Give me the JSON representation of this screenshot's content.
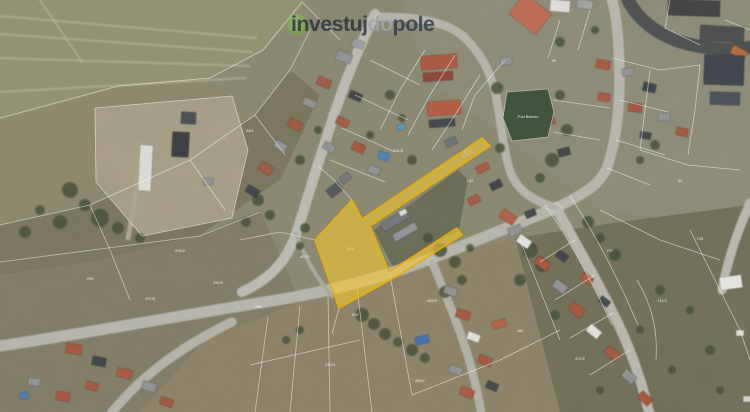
{
  "logo": {
    "part1": "investuj",
    "part2": "do",
    "part3": "pole",
    "part1_color": "rgba(37,47,60,0.80)",
    "part2_color": "rgba(157,165,172,0.85)",
    "part3_color": "rgba(42,55,70,0.80)",
    "mark_color": "rgba(110,170,60,0.55)"
  },
  "highlight": {
    "path": "M352,200 L362,219 L482,138 L490,146 L370,226 L389,272 L457,228 L462,235 L397,276 L339,308 L315,240 Z",
    "fill": "#f8c92f",
    "fill_opacity": 0.58,
    "stroke": "#e7b007"
  },
  "pond": {
    "path": "M507,92 L548,89 L554,112 L548,137 L512,141 L503,118 Z",
    "fill": "#3b5038",
    "label": "Pod Březím",
    "label_x": 528,
    "label_y": 118
  },
  "map": {
    "regions": [
      {
        "pts": "0,0 750,0 750,412 0,412",
        "fill": "#88866e",
        "op": 1
      },
      {
        "pts": "400,0 750,0 750,230 600,210 430,80",
        "fill": "#8e8c7a",
        "op": 0.65
      },
      {
        "pts": "0,0 308,0 262,52 208,80 118,88 0,120",
        "fill": "#91906f",
        "op": 1
      },
      {
        "pts": "0,120 118,88 208,80 250,120 170,170 60,205 0,225",
        "fill": "#8b8568",
        "op": 1
      },
      {
        "pts": "0,225 90,205 190,160 255,115 290,70 320,95 280,180 200,235 90,262 0,275",
        "fill": "#767157",
        "op": 0.9
      },
      {
        "pts": "95,108 232,96 248,150 232,218 142,236 96,182",
        "fill": "#a79d85",
        "op": 1
      },
      {
        "pts": "0,275 90,262 200,235 260,210 300,302 205,340 140,412 0,412",
        "fill": "#7d7861",
        "op": 0.9
      },
      {
        "pts": "140,412 205,340 300,302 430,262 515,238 560,412",
        "fill": "#8b8065",
        "op": 1
      },
      {
        "pts": "515,238 560,412 750,412 750,205 620,222",
        "fill": "#6e6b53",
        "op": 1
      },
      {
        "pts": "374,230 458,170 468,180 459,230 393,267",
        "fill": "#5a5e47",
        "op": 0.75
      }
    ],
    "tracks": [
      "M0,16 L256,38",
      "M0,34 L252,52",
      "M0,58 L250,66",
      "M0,92 L246,78",
      "M40,0 L82,62"
    ],
    "roads": [
      {
        "d": "M628,0 C638,20 658,36 688,44 C714,50 736,51 750,47",
        "w": 13,
        "c": "#4b4e4f",
        "e": 0
      },
      {
        "d": "M375,14 C360,45 341,90 326,140 C315,172 306,204 296,234 C287,260 272,278 242,292",
        "w": 9,
        "c": "#bab9b0",
        "e": 1
      },
      {
        "d": "M0,346 C100,331 200,312 265,302 C330,292 380,278 425,261 C455,249 522,222 556,208",
        "w": 10,
        "c": "#b5b4aa",
        "e": 1
      },
      {
        "d": "M556,208 C583,194 599,186 607,168 C617,138 621,100 619,58 C618,28 615,10 612,0",
        "w": 9,
        "c": "#b5b4aa",
        "e": 1
      },
      {
        "d": "M556,208 C573,238 593,273 613,313 C628,343 641,378 649,412",
        "w": 9,
        "c": "#b7b6ac",
        "e": 1
      },
      {
        "d": "M380,17 C420,16 452,24 466,39 C482,55 491,73 496,96 C501,121 503,149 510,171 C517,191 534,201 556,208",
        "w": 7,
        "c": "#b3b2a8",
        "e": 1
      },
      {
        "d": "M112,412 C138,381 172,351 232,322",
        "w": 8,
        "c": "#b2b1a7",
        "e": 1
      },
      {
        "d": "M432,262 C446,295 459,327 468,356 C475,381 479,398 481,412",
        "w": 7,
        "c": "#b0afa5",
        "e": 1
      },
      {
        "d": "M750,203 C738,230 728,258 722,290",
        "w": 8,
        "c": "#b7b6ac",
        "e": 1
      },
      {
        "d": "M141,143 C139,172 136,198 128,238",
        "w": 5,
        "c": "#aaa28c",
        "e": 0
      },
      {
        "d": "M296,234 C306,260 318,280 332,296",
        "w": 4,
        "c": "#a8a79b",
        "e": 0
      }
    ],
    "cad_lines": [
      "M0,118 L118,86 L210,78 L263,50 L302,2",
      "M0,225 L90,205 L190,160 L255,115 L290,70 L310,30",
      "M90,205 L110,250 L130,300",
      "M190,160 L225,210",
      "M255,115 L285,155",
      "M95,108 L232,96 L248,150 L232,218 L142,236 L96,182 L95,108",
      "M0,262 L200,236 L260,212",
      "M268,317 L255,412",
      "M300,306 L290,412",
      "M328,296 L330,412",
      "M357,288 L372,412",
      "M390,275 L412,395",
      "M250,365 L360,340",
      "M412,395 L500,360 L560,330",
      "M315,240 L280,232 L240,240",
      "M352,200 L334,180 L318,166",
      "M339,308 L332,334",
      "M425,50 L400,90 L380,130",
      "M455,55 L430,95 L408,135",
      "M480,75 L455,115 L432,150",
      "M370,60 L420,85",
      "M355,95 L408,120",
      "M342,128 L395,152",
      "M330,160 L385,182",
      "M505,60 L475,95 L462,130",
      "M553,100 L610,108",
      "M553,132 L600,140",
      "M560,20 L548,58",
      "M590,10 L578,50",
      "M612,58 L660,70 L700,65",
      "M620,100 L668,112",
      "M616,140 L665,155",
      "M607,168 L650,185",
      "M650,70 L645,110 L640,150",
      "M700,65 L695,110 L688,155",
      "M640,150 L688,165 L740,170",
      "M600,210 L660,240 L720,260",
      "M575,240 L540,262",
      "M595,275 L555,300",
      "M613,313 L570,338",
      "M630,350 L590,375",
      "M545,205 C570,240 592,282 612,325",
      "M570,196 C596,235 618,278 638,325",
      "M637,280 C652,305 658,330 656,360",
      "M690,230 L740,330 L750,360",
      "M520,240 L560,340",
      "M670,0 L665,28 L700,45",
      "M725,20 L750,30",
      "M302,2 L340,40"
    ],
    "buildings": [
      [
        421,
        55,
        36,
        14,
        -4,
        "#a85741"
      ],
      [
        423,
        72,
        30,
        9,
        -4,
        "#8a4636"
      ],
      [
        427,
        101,
        34,
        14,
        -4,
        "#b05a40"
      ],
      [
        429,
        119,
        26,
        8,
        -4,
        "#41454b"
      ],
      [
        445,
        138,
        12,
        8,
        -25,
        "#6e7173"
      ],
      [
        336,
        52,
        16,
        10,
        18,
        "#8f9092"
      ],
      [
        352,
        40,
        12,
        8,
        18,
        "#9b9c9e"
      ],
      [
        317,
        78,
        14,
        9,
        24,
        "#9c5a45"
      ],
      [
        303,
        99,
        13,
        8,
        24,
        "#8e8f91"
      ],
      [
        288,
        120,
        14,
        9,
        27,
        "#a2563f"
      ],
      [
        274,
        142,
        13,
        8,
        29,
        "#909193"
      ],
      [
        259,
        164,
        14,
        9,
        30,
        "#9b5a45"
      ],
      [
        246,
        187,
        13,
        8,
        31,
        "#3f4347"
      ],
      [
        349,
        92,
        13,
        8,
        24,
        "#3e4246"
      ],
      [
        336,
        118,
        13,
        8,
        27,
        "#a25843"
      ],
      [
        323,
        143,
        12,
        8,
        28,
        "#8d8e90"
      ],
      [
        352,
        143,
        13,
        9,
        24,
        "#a5543e"
      ],
      [
        368,
        166,
        12,
        8,
        20,
        "#90918f"
      ],
      [
        327,
        185,
        15,
        10,
        -38,
        "#53565a"
      ],
      [
        340,
        174,
        11,
        8,
        -38,
        "#737577"
      ],
      [
        380,
        216,
        30,
        9,
        -30,
        "#71747a"
      ],
      [
        392,
        228,
        26,
        8,
        -30,
        "#8f9296"
      ],
      [
        399,
        210,
        8,
        5,
        -30,
        "#dcdcd8"
      ],
      [
        460,
        148,
        14,
        9,
        -28,
        "#8f9092"
      ],
      [
        476,
        164,
        13,
        8,
        -28,
        "#a5563f"
      ],
      [
        490,
        181,
        12,
        8,
        -26,
        "#3e4246"
      ],
      [
        468,
        196,
        12,
        8,
        -26,
        "#a2563f"
      ],
      [
        508,
        226,
        14,
        9,
        -22,
        "#8e8f91"
      ],
      [
        525,
        210,
        11,
        7,
        -22,
        "#43474b"
      ],
      [
        500,
        57,
        12,
        8,
        -12,
        "#909193"
      ],
      [
        545,
        118,
        10,
        7,
        -15,
        "#a25843"
      ],
      [
        558,
        148,
        12,
        8,
        -15,
        "#3e4246"
      ],
      [
        513,
        1,
        34,
        26,
        38,
        "#bc6a52"
      ],
      [
        550,
        0,
        20,
        12,
        5,
        "#dcdbd6"
      ],
      [
        577,
        0,
        16,
        9,
        8,
        "#9fa09c"
      ],
      [
        668,
        0,
        52,
        16,
        2,
        "#3f4142"
      ],
      [
        700,
        26,
        44,
        16,
        3,
        "#4a4c4d"
      ],
      [
        731,
        48,
        16,
        9,
        28,
        "#b46a3a"
      ],
      [
        704,
        55,
        40,
        30,
        2,
        "#3d434b"
      ],
      [
        710,
        92,
        30,
        13,
        2,
        "#494f57"
      ],
      [
        596,
        60,
        14,
        9,
        10,
        "#a2563f"
      ],
      [
        622,
        68,
        12,
        8,
        -6,
        "#8f9092"
      ],
      [
        643,
        83,
        13,
        9,
        14,
        "#3e4246"
      ],
      [
        598,
        93,
        12,
        8,
        8,
        "#a85741"
      ],
      [
        628,
        103,
        14,
        9,
        8,
        "#9e5640"
      ],
      [
        658,
        113,
        12,
        8,
        10,
        "#8f9092"
      ],
      [
        676,
        128,
        12,
        8,
        12,
        "#a2563f"
      ],
      [
        640,
        132,
        11,
        7,
        10,
        "#42464a"
      ],
      [
        500,
        212,
        16,
        10,
        35,
        "#ad5f49"
      ],
      [
        517,
        237,
        14,
        9,
        35,
        "#dfded9"
      ],
      [
        535,
        259,
        15,
        9,
        36,
        "#a5543e"
      ],
      [
        553,
        282,
        14,
        9,
        37,
        "#8f9092"
      ],
      [
        569,
        305,
        15,
        10,
        38,
        "#a5543e"
      ],
      [
        587,
        327,
        14,
        9,
        39,
        "#e0dfda"
      ],
      [
        605,
        349,
        15,
        9,
        40,
        "#a2563f"
      ],
      [
        622,
        372,
        14,
        9,
        41,
        "#8f9092"
      ],
      [
        556,
        252,
        12,
        8,
        36,
        "#3e4246"
      ],
      [
        581,
        275,
        12,
        8,
        37,
        "#a85741"
      ],
      [
        599,
        298,
        11,
        7,
        38,
        "#43474b"
      ],
      [
        638,
        394,
        14,
        9,
        42,
        "#a5543e"
      ],
      [
        444,
        287,
        13,
        8,
        18,
        "#8f9092"
      ],
      [
        456,
        310,
        14,
        9,
        18,
        "#a5543e"
      ],
      [
        467,
        333,
        13,
        8,
        20,
        "#dfded9"
      ],
      [
        478,
        356,
        14,
        9,
        20,
        "#a2563f"
      ],
      [
        449,
        366,
        13,
        8,
        20,
        "#8f9092"
      ],
      [
        460,
        388,
        14,
        9,
        22,
        "#a85741"
      ],
      [
        486,
        382,
        12,
        8,
        22,
        "#43474b"
      ],
      [
        492,
        320,
        14,
        8,
        -15,
        "#b0603f"
      ],
      [
        415,
        336,
        14,
        8,
        -14,
        "#3f6fb0"
      ],
      [
        66,
        344,
        16,
        10,
        8,
        "#a5543e"
      ],
      [
        92,
        357,
        14,
        9,
        11,
        "#3e4246"
      ],
      [
        117,
        369,
        15,
        9,
        14,
        "#a85741"
      ],
      [
        142,
        382,
        14,
        9,
        17,
        "#8f9092"
      ],
      [
        86,
        382,
        12,
        8,
        12,
        "#a2563f"
      ],
      [
        56,
        392,
        14,
        9,
        9,
        "#a5543e"
      ],
      [
        28,
        378,
        12,
        8,
        6,
        "#8f9092"
      ],
      [
        160,
        398,
        13,
        8,
        18,
        "#9e5640"
      ],
      [
        139,
        145,
        13,
        46,
        3,
        "#dad9d3"
      ],
      [
        172,
        132,
        17,
        25,
        3,
        "#3a3d40"
      ],
      [
        181,
        112,
        15,
        12,
        3,
        "#4a4d50"
      ],
      [
        203,
        178,
        10,
        7,
        3,
        "#8e8f91"
      ],
      [
        720,
        276,
        22,
        13,
        -8,
        "#e4e3de"
      ],
      [
        736,
        330,
        8,
        6,
        0,
        "#d8d7d2"
      ],
      [
        743,
        396,
        8,
        6,
        0,
        "#cfceca"
      ]
    ],
    "pools": [
      [
        378,
        152,
        11,
        8,
        22,
        "#4a80b4"
      ],
      [
        397,
        124,
        8,
        6,
        -20,
        "#5d92c4"
      ],
      [
        20,
        392,
        8,
        7,
        0,
        "#4a7fb0"
      ]
    ],
    "trees": [
      [
        70,
        190,
        8
      ],
      [
        85,
        205,
        6
      ],
      [
        100,
        218,
        9
      ],
      [
        60,
        222,
        7
      ],
      [
        118,
        228,
        6
      ],
      [
        40,
        210,
        5
      ],
      [
        25,
        232,
        6
      ],
      [
        140,
        238,
        5
      ],
      [
        258,
        200,
        6
      ],
      [
        270,
        215,
        5
      ],
      [
        246,
        222,
        5
      ],
      [
        305,
        228,
        5
      ],
      [
        300,
        246,
        4
      ],
      [
        440,
        250,
        7
      ],
      [
        455,
        262,
        6
      ],
      [
        428,
        238,
        5
      ],
      [
        462,
        280,
        5
      ],
      [
        445,
        292,
        6
      ],
      [
        470,
        248,
        4
      ],
      [
        362,
        315,
        7
      ],
      [
        374,
        324,
        6
      ],
      [
        385,
        334,
        6
      ],
      [
        398,
        342,
        5
      ],
      [
        412,
        350,
        6
      ],
      [
        425,
        358,
        5
      ],
      [
        300,
        330,
        4
      ],
      [
        286,
        340,
        4
      ],
      [
        497,
        88,
        6
      ],
      [
        560,
        95,
        5
      ],
      [
        567,
        130,
        6
      ],
      [
        552,
        160,
        7
      ],
      [
        540,
        178,
        5
      ],
      [
        500,
        148,
        5
      ],
      [
        588,
        222,
        6
      ],
      [
        600,
        238,
        5
      ],
      [
        615,
        255,
        6
      ],
      [
        530,
        250,
        8
      ],
      [
        542,
        265,
        7
      ],
      [
        520,
        280,
        6
      ],
      [
        555,
        315,
        5
      ],
      [
        660,
        290,
        5
      ],
      [
        690,
        310,
        4
      ],
      [
        710,
        350,
        5
      ],
      [
        672,
        370,
        4
      ],
      [
        640,
        330,
        4
      ],
      [
        720,
        390,
        4
      ],
      [
        600,
        390,
        4
      ],
      [
        655,
        145,
        5
      ],
      [
        640,
        160,
        4
      ],
      [
        560,
        42,
        5
      ],
      [
        595,
        30,
        4
      ],
      [
        390,
        95,
        5
      ],
      [
        402,
        118,
        4
      ],
      [
        370,
        135,
        4
      ],
      [
        412,
        160,
        5
      ],
      [
        300,
        160,
        5
      ],
      [
        318,
        130,
        4
      ]
    ],
    "parcel_labels": [
      [
        180,
        252,
        "294/2"
      ],
      [
        218,
        284,
        "292/5"
      ],
      [
        258,
        308,
        "290"
      ],
      [
        305,
        258,
        "407/1"
      ],
      [
        355,
        316,
        "409"
      ],
      [
        432,
        302,
        "449/3"
      ],
      [
        520,
        332,
        "466"
      ],
      [
        610,
        252,
        "737"
      ],
      [
        662,
        302,
        "741/2"
      ],
      [
        250,
        132,
        "88/1"
      ],
      [
        470,
        182,
        "132"
      ],
      [
        554,
        62,
        "95"
      ],
      [
        398,
        152,
        "121/4"
      ],
      [
        680,
        182,
        "52"
      ],
      [
        150,
        300,
        "297/8"
      ],
      [
        90,
        280,
        "299"
      ],
      [
        420,
        382,
        "455/1"
      ],
      [
        580,
        360,
        "472/2"
      ],
      [
        330,
        366,
        "412/3"
      ],
      [
        700,
        240,
        "745"
      ],
      [
        350,
        250,
        "403"
      ]
    ]
  }
}
